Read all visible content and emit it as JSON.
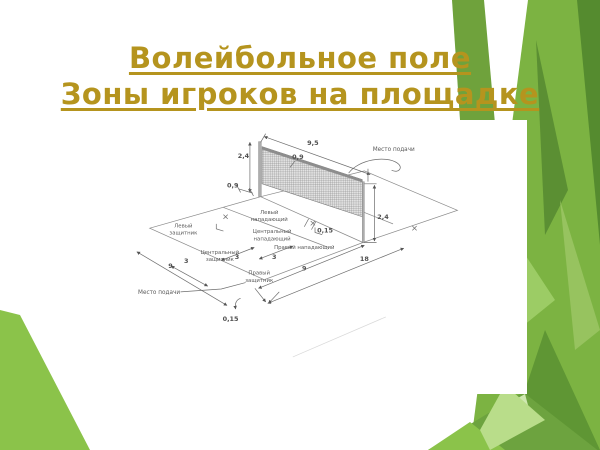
{
  "slide": {
    "title_line1": "Волейбольное поле",
    "title_line2": "Зоны игроков на площадке",
    "title_color": "#b5941e",
    "accent_greens": [
      "#7cb342",
      "#6fa23c",
      "#558b2f",
      "#8bc34a",
      "#a5d06a",
      "#b9dd8a"
    ]
  },
  "diagram": {
    "dimensions": {
      "post_height_left": "2,4",
      "net_length": "9,5",
      "net_band_height": "0,9",
      "post_offset": "0,9",
      "post_height_right": "2,4",
      "line_width_mid": "0,15",
      "line_width_bottom": "0,15",
      "zone_3_a": "3",
      "zone_3_b": "3",
      "zone_3_c": "3",
      "half_9_left": "9",
      "half_9_right": "9",
      "court_length": "18"
    },
    "labels": {
      "serve_spot_top": "Место подачи",
      "serve_spot_bottom": "Место подачи",
      "left_defender": {
        "l1": "Левый",
        "l2": "защитник"
      },
      "left_attacker": {
        "l1": "Левый",
        "l2": "нападающий"
      },
      "center_attacker": {
        "l1": "Центральный",
        "l2": "нападающий"
      },
      "right_attacker": "Правый нападающий",
      "center_defender": {
        "l1": "Центральный",
        "l2": "защитник"
      },
      "right_defender": {
        "l1": "Правый",
        "l2": "защитник"
      }
    }
  }
}
